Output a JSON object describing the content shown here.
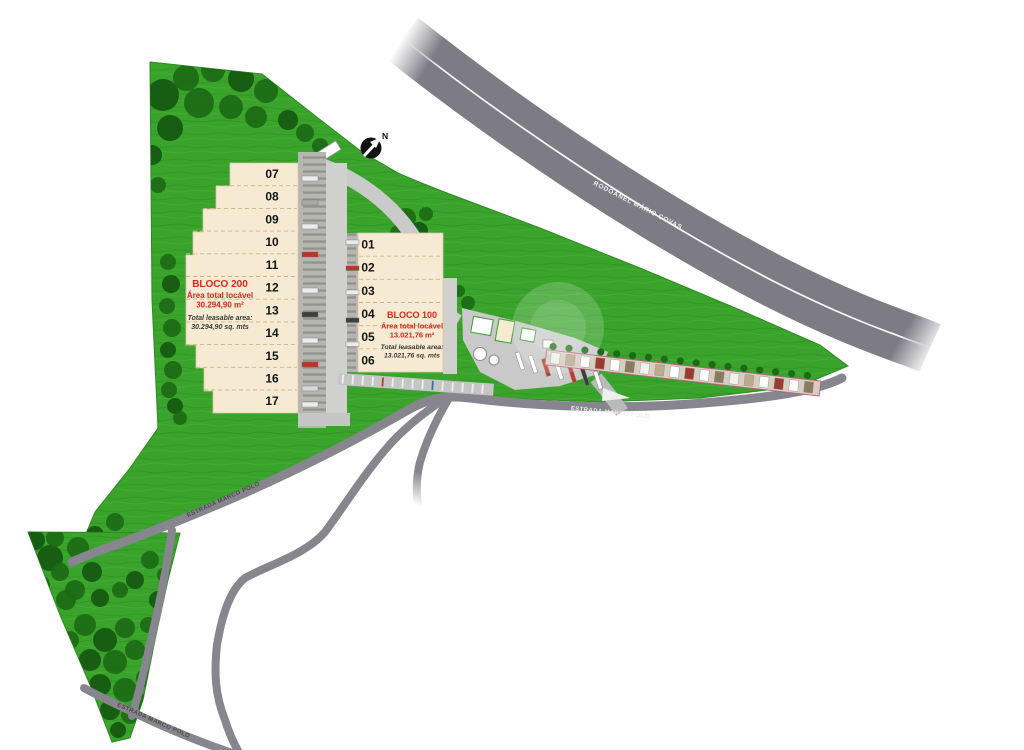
{
  "compass": {
    "north_label": "N"
  },
  "highway": {
    "name": "RODOANEL MÁRIO COVAS"
  },
  "road": {
    "name": "ESTRADA MARCO POLO"
  },
  "colors": {
    "grass": "#3aa32c",
    "tree": "#1c6a15",
    "road_gray": "#87868e",
    "highway_gray": "#7d7c85",
    "building_cream": "#f6ead2",
    "accent_red": "#e0251c"
  },
  "blocks": [
    {
      "name": "BLOCO 200",
      "area_line1": "Área total locável",
      "area_line2": "30.294,90 m²",
      "leasable_line1": "Total leasable area:",
      "leasable_line2": "30.294,90 sq. mts",
      "units": [
        "07",
        "08",
        "09",
        "10",
        "11",
        "12",
        "13",
        "14",
        "15",
        "16",
        "17"
      ]
    },
    {
      "name": "BLOCO 100",
      "area_line1": "Área total locável",
      "area_line2": "13.021,76 m²",
      "leasable_line1": "Total leasable area:",
      "leasable_line2": "13.021,76 sq. mts",
      "units": [
        "01",
        "02",
        "03",
        "04",
        "05",
        "06"
      ]
    }
  ]
}
